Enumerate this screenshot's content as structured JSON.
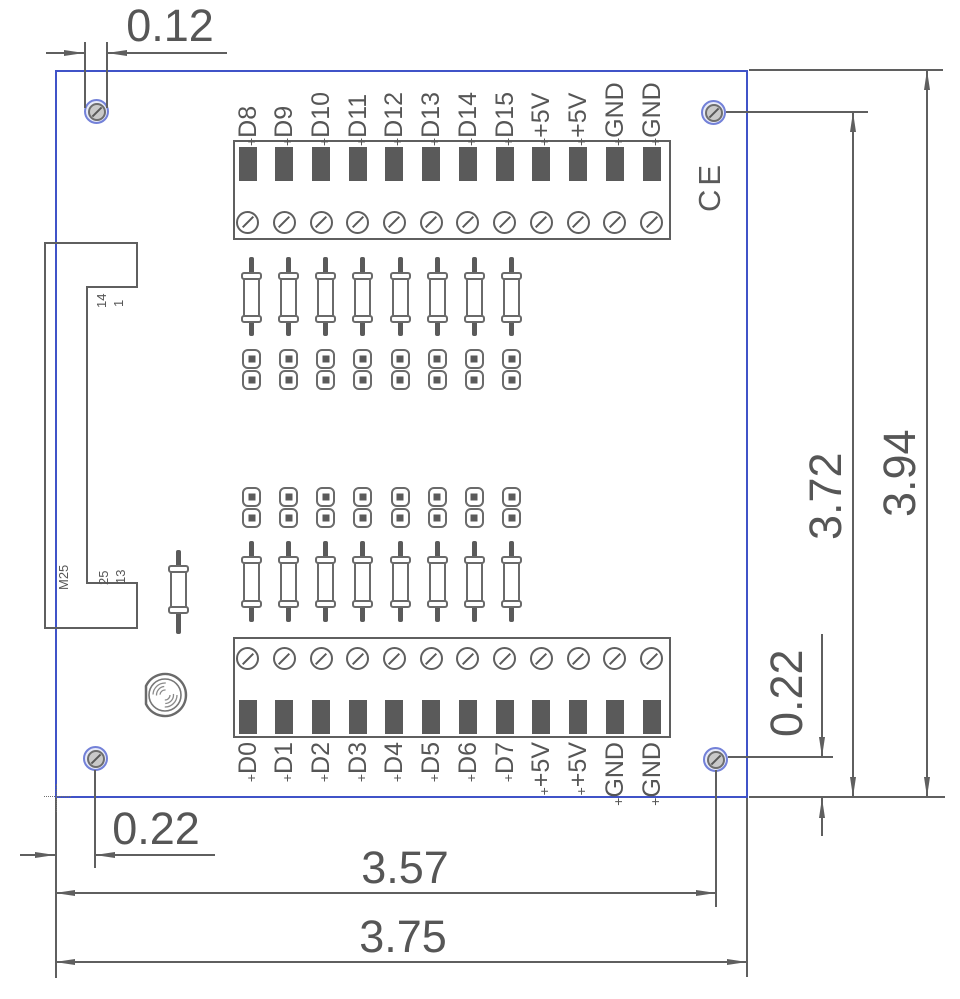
{
  "drawing": {
    "pin_marker": "+",
    "top_terminal_labels": [
      "D8",
      "D9",
      "D10",
      "D11",
      "D12",
      "D13",
      "D14",
      "D15",
      "+5V",
      "+5V",
      "GND",
      "GND"
    ],
    "bottom_terminal_labels": [
      "D0",
      "D1",
      "D2",
      "D3",
      "D4",
      "D5",
      "D6",
      "D7",
      "+5V",
      "+5V",
      "GND",
      "GND"
    ],
    "connector": {
      "label": "M25",
      "pin_top_left": "14",
      "pin_top_right": "1",
      "pin_bottom_left": "25",
      "pin_bottom_right": "13"
    },
    "ce_mark": "CE",
    "dimensions": {
      "hole_diameter": "0.12",
      "board_height": "3.94",
      "hole_to_bottom_edge": "3.72",
      "right_hole_to_bottom_edge": "0.22",
      "left_edge_to_hole": "0.22",
      "left_edge_to_right_hole": "3.57",
      "board_width": "3.75"
    },
    "colors": {
      "board_outline": "#4053c8",
      "drawing_line": "#5f5f5f",
      "pad_fill": "#5a5a5a"
    }
  }
}
